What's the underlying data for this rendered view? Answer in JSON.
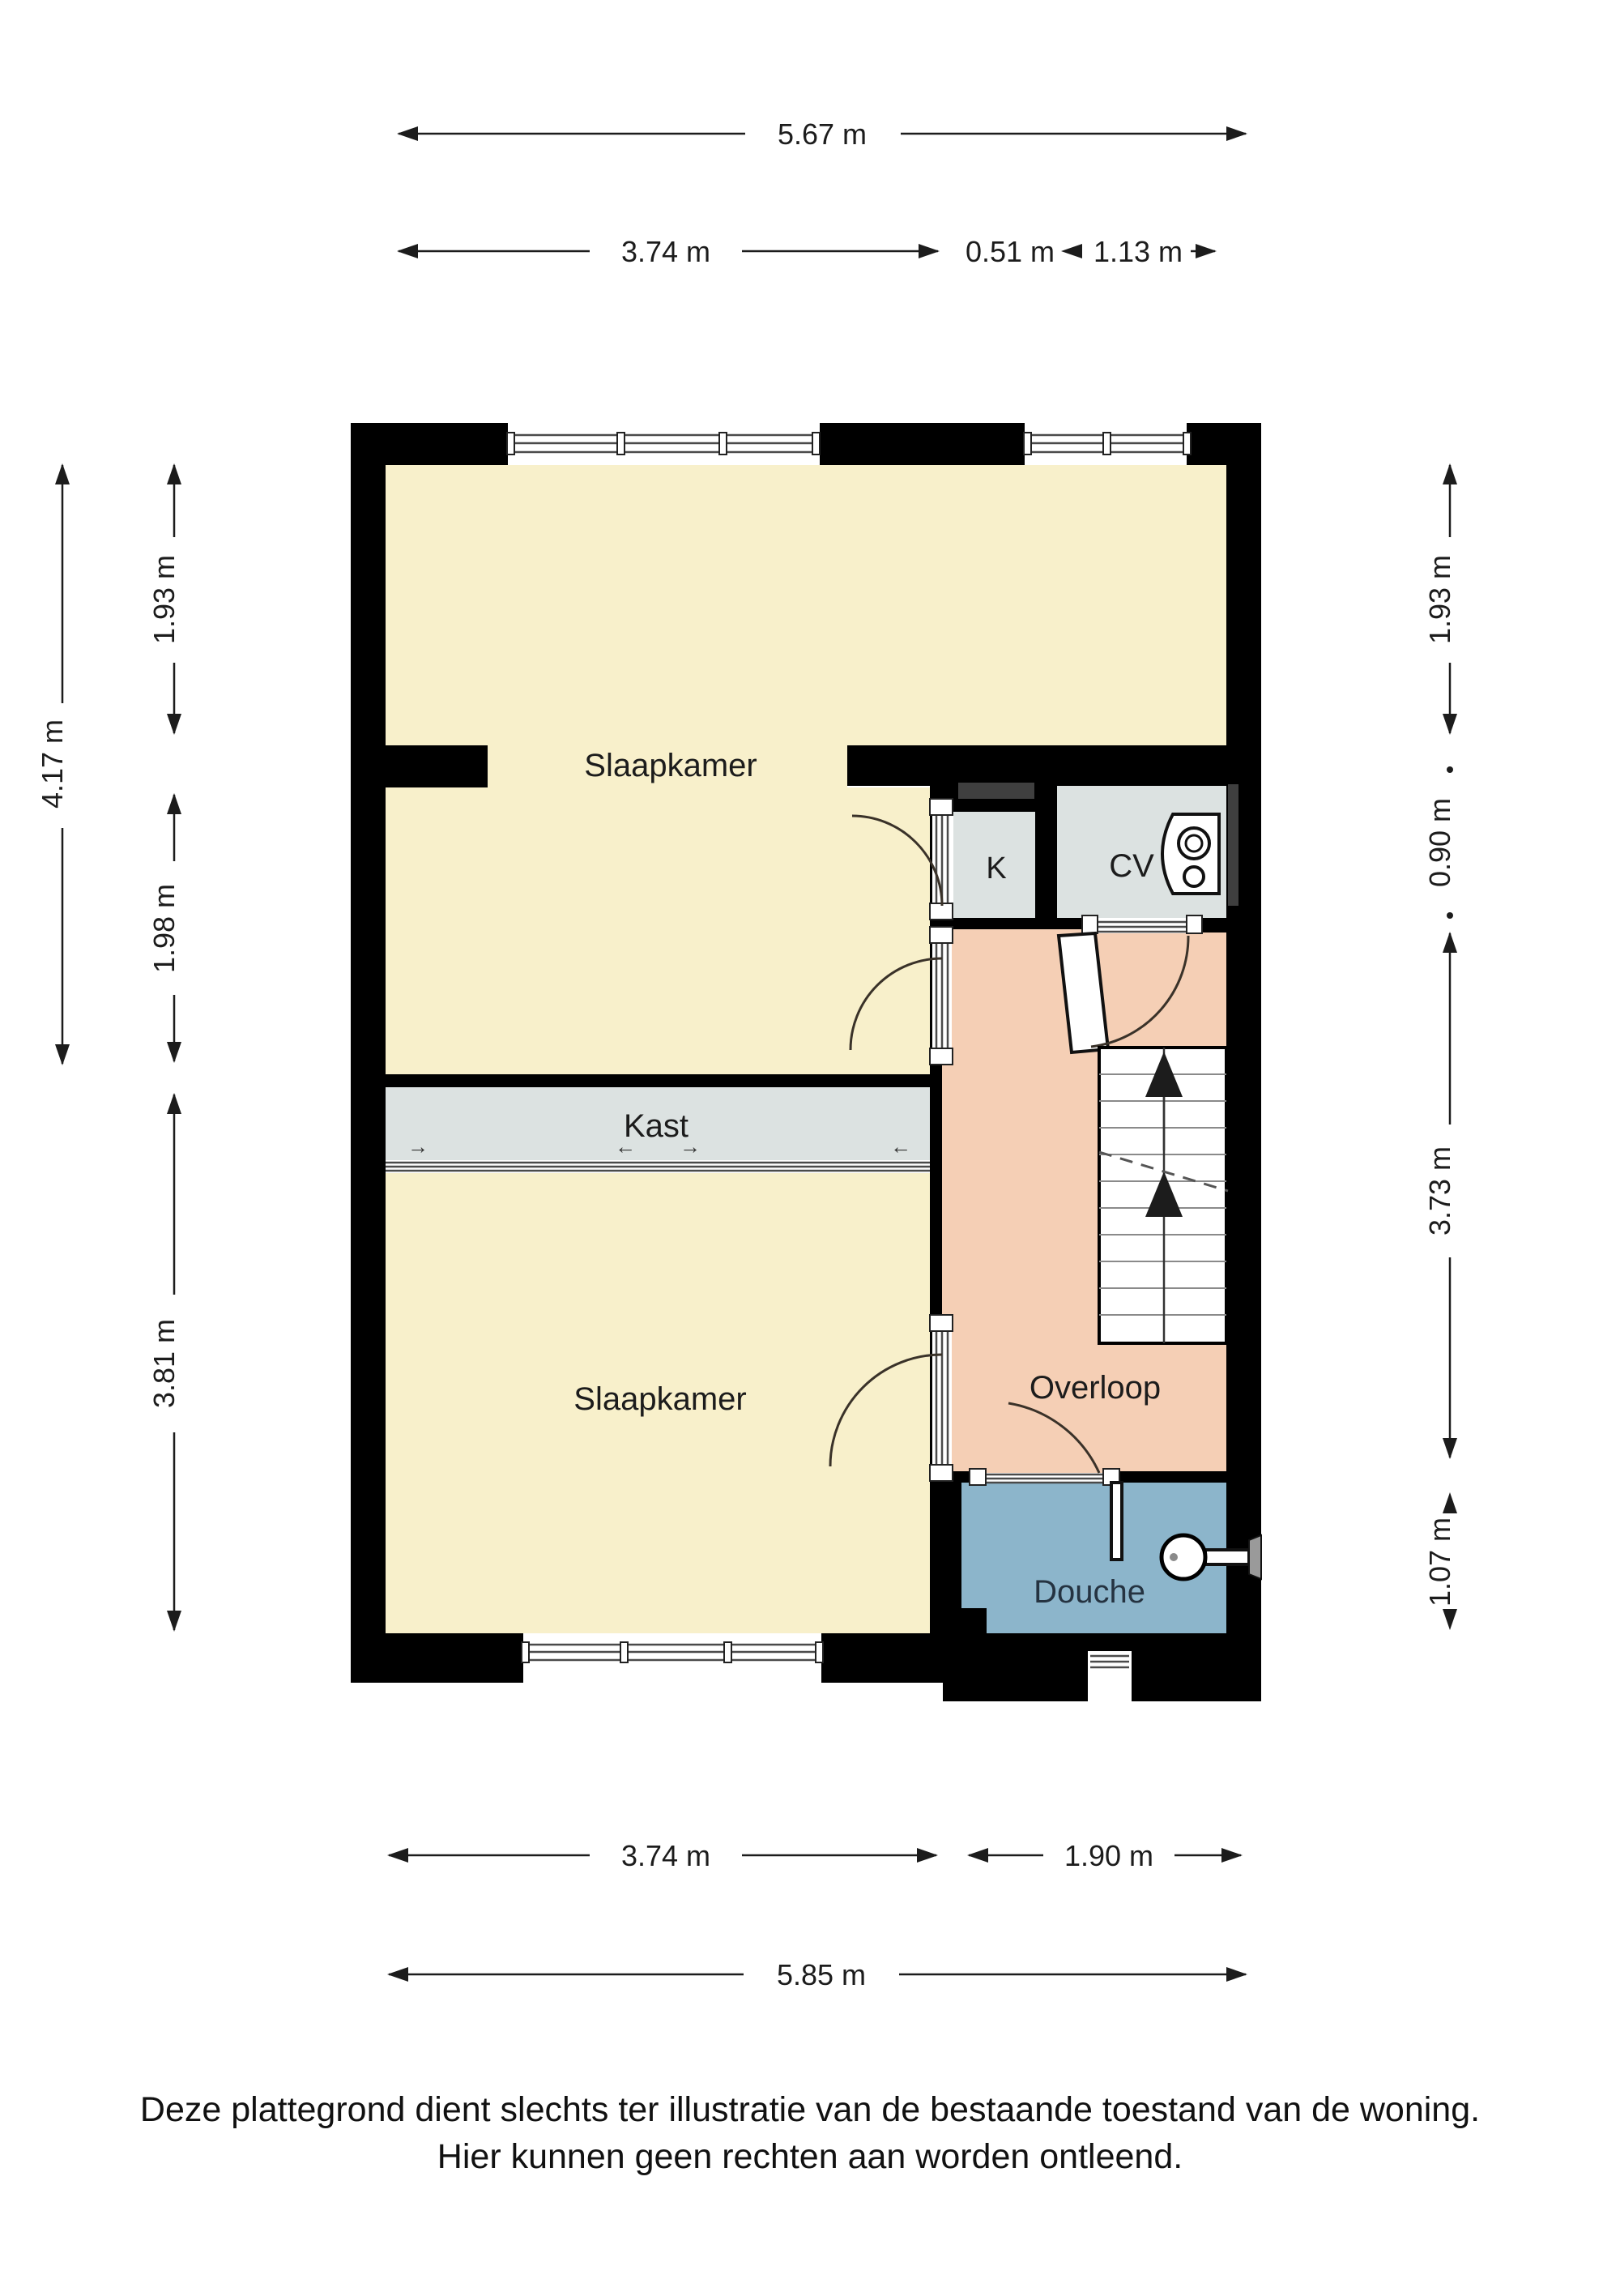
{
  "floorplan": {
    "rooms": {
      "bedroom_top": {
        "label": "Slaapkamer"
      },
      "bedroom_bottom": {
        "label": "Slaapkamer"
      },
      "closet": {
        "label": "Kast"
      },
      "closet_small": {
        "label": "K"
      },
      "boiler_room": {
        "label": "CV"
      },
      "landing": {
        "label": "Overloop"
      },
      "shower_room": {
        "label": "Douche"
      }
    },
    "colors": {
      "wall": "#000000",
      "bedroom": "#f8f0cb",
      "closet": "#dce2e1",
      "landing": "#f5cfb5",
      "shower": "#8cb5cb",
      "duct": "#3f3f3f"
    },
    "dimensions": {
      "top_total": "5.67 m",
      "top_left": "3.74 m",
      "top_mid": "0.51 m",
      "top_right": "1.13 m",
      "left_total": "4.17 m",
      "left_upper": "1.93 m",
      "left_middle": "1.98 m",
      "left_lower": "3.81 m",
      "right_upper": "1.93 m",
      "right_cv": "0.90 m",
      "right_middle": "3.73 m",
      "right_lower": "1.07 m",
      "bottom_left": "3.74 m",
      "bottom_right": "1.90 m",
      "bottom_total": "5.85 m"
    },
    "closet_arrows": {
      "a1": "→",
      "a2": "←",
      "a3": "→",
      "a4": "←"
    },
    "footer": {
      "line1": "Deze plattegrond dient slechts ter illustratie van de bestaande toestand van de woning.",
      "line2": "Hier kunnen geen rechten aan worden ontleend."
    }
  }
}
